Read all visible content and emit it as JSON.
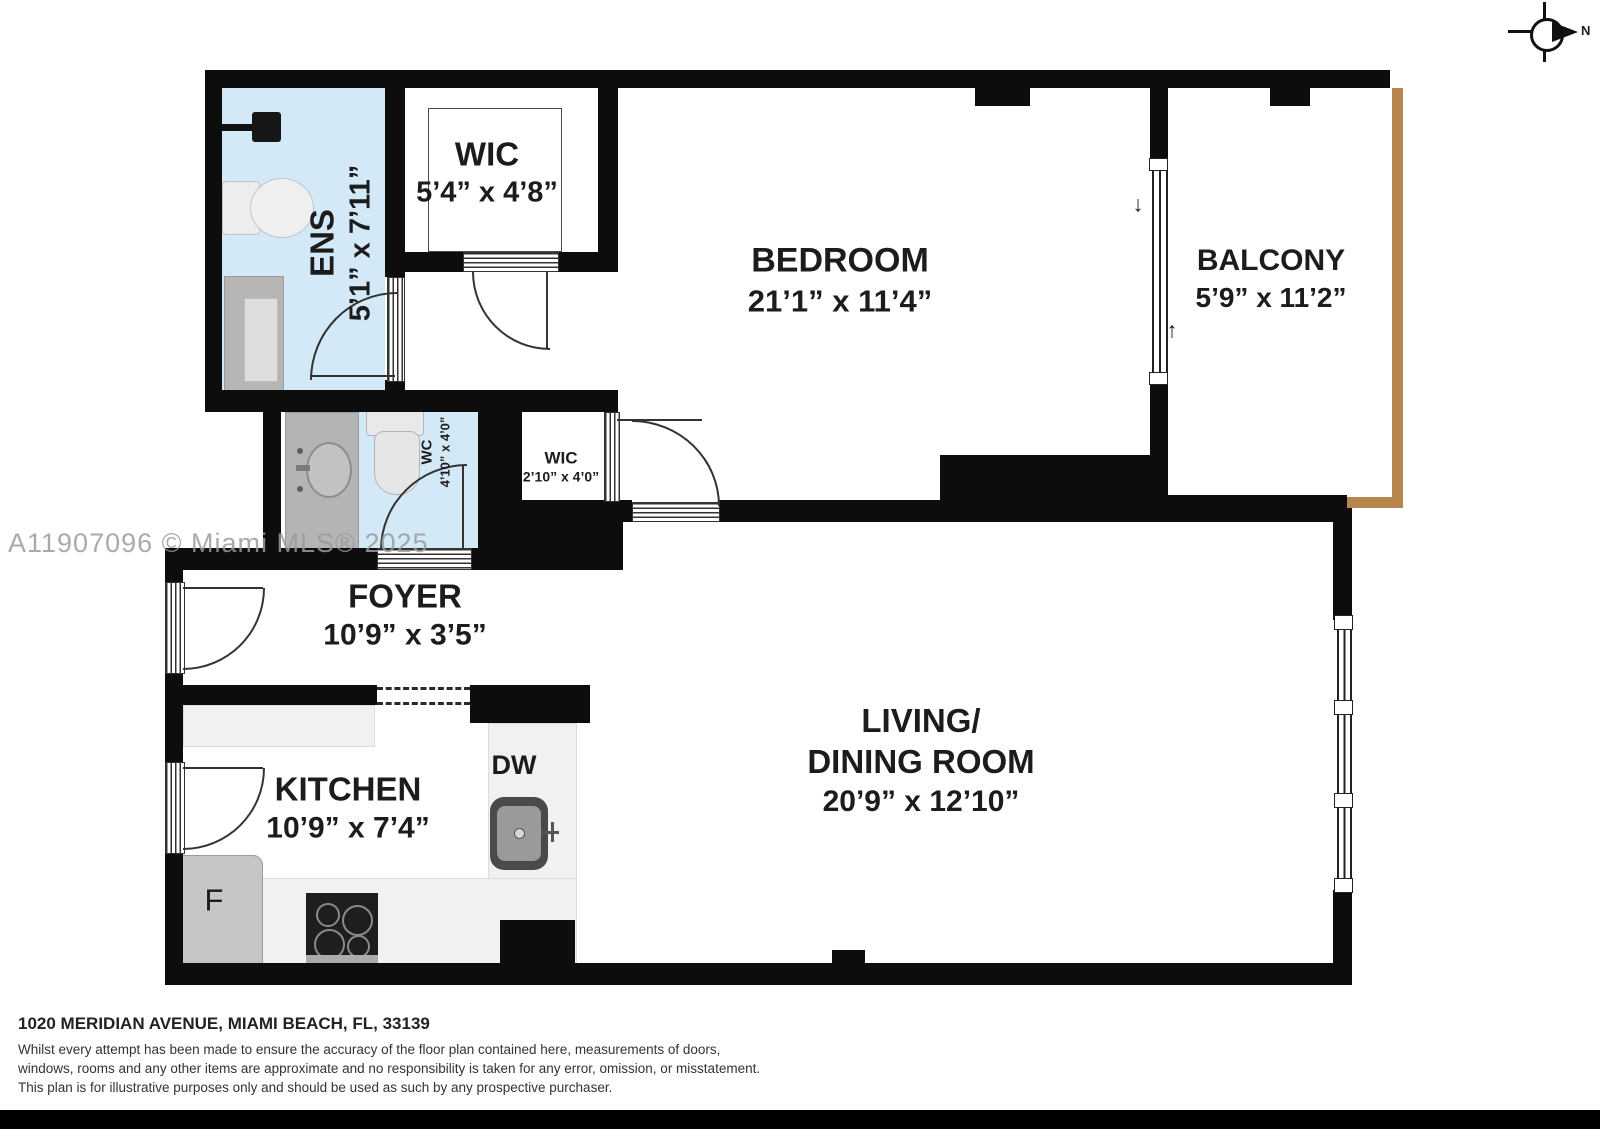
{
  "compass": {
    "north_label": "N"
  },
  "watermark": "A11907096 © Miami MLS® 2025",
  "rooms": {
    "ens": {
      "name": "ENS",
      "dims": "5’1” x 7’11”"
    },
    "wic_top": {
      "name": "WIC",
      "dims": "5’4” x 4’8”"
    },
    "bedroom": {
      "name": "BEDROOM",
      "dims": "21’1” x 11’4”"
    },
    "balcony": {
      "name": "BALCONY",
      "dims": "5’9” x 11’2”"
    },
    "wc": {
      "name": "WC",
      "dims": "4’10” x 4’0”"
    },
    "wic_small": {
      "name": "WIC",
      "dims": "2’10” x 4’0”"
    },
    "foyer": {
      "name": "FOYER",
      "dims": "10’9” x 3’5”"
    },
    "kitchen": {
      "name": "KITCHEN",
      "dims": "10’9” x 7’4”"
    },
    "living_dining": {
      "name_line1": "LIVING/",
      "name_line2": "DINING ROOM",
      "dims": "20’9” x 12’10”"
    }
  },
  "appliances": {
    "dishwasher_label": "DW",
    "fridge_label": "F"
  },
  "footer": {
    "address": "1020 MERIDIAN AVENUE, MIAMI BEACH, FL, 33139",
    "disclaimer_line1": "Whilst every attempt has been made to ensure the accuracy of the floor plan contained here, measurements of doors,",
    "disclaimer_line2": "windows, rooms and any other items are approximate and no responsibility is taken for any error, omission, or misstatement.",
    "disclaimer_line3": "This plan is for illustrative purposes only and should be used as such by any prospective purchaser."
  },
  "colors": {
    "wall": "#0d0d0d",
    "wet_room_fill": "#d3e9f7",
    "railing": "#b5854d"
  }
}
